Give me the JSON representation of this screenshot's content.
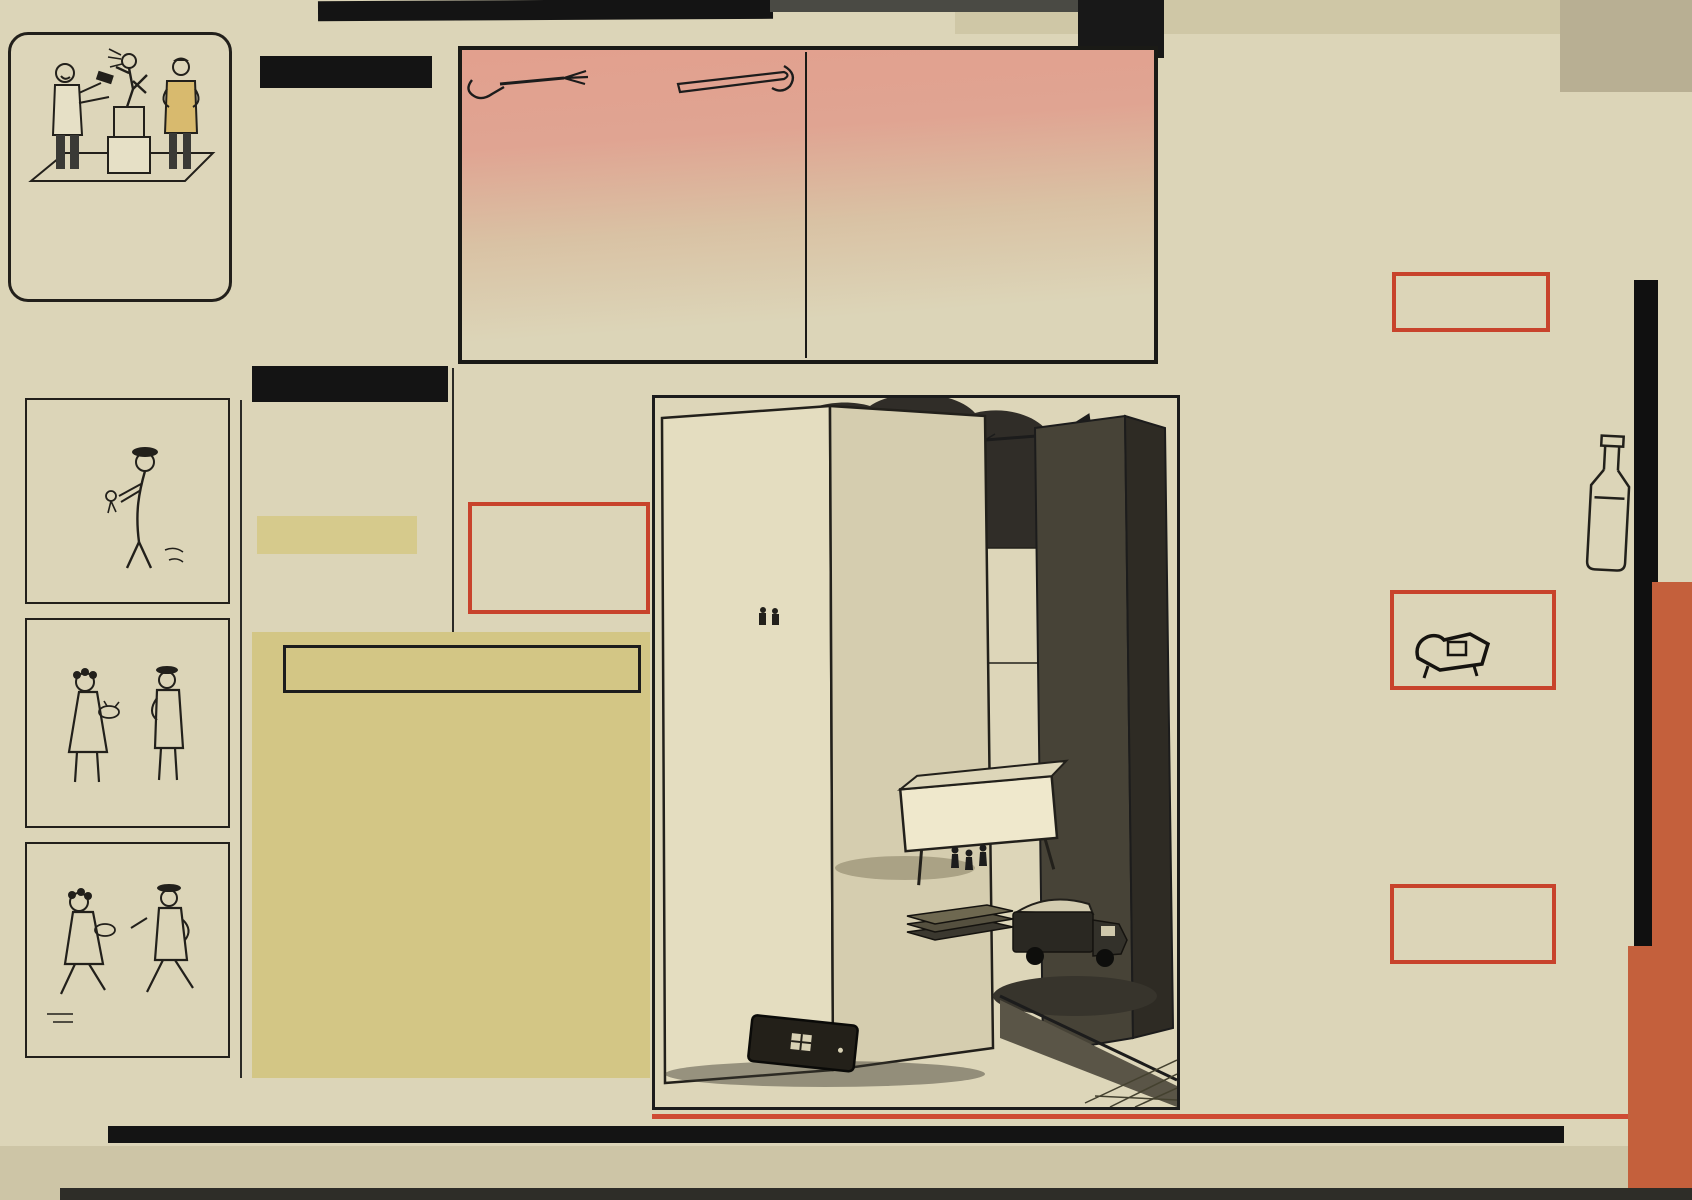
{
  "pzu": {
    "caption_l1": "–To JEST RZEŹBA CZŁOWIEKA",
    "caption_l2": "RADOSNEGO bo UBEZPIECZO-",
    "caption_l3a": "NEGO w ",
    "caption_l3b": "PZU",
    "caption_l3c": " od WYPADKÓW",
    "caption_l4": "NIESZCZĘŚLIWYCH",
    "code": "K—401"
  },
  "lengren": {
    "credit": "Rys. ZBIGNIEW LENGREN",
    "signature": "LENGREN"
  },
  "nieslychane": {
    "title": "NIESŁYCHANE!",
    "p1": "Z „Dziennika Polskiego” dowiadujemy się, że:",
    "p2": "Irena Kirszenstein znakomicie godzi studia z zajęciami naukowymi.",
    "p3": "I to ma być takie dziwne?",
    "credit": "(Nadesłała: K. Zgud-Bikart)"
  },
  "zachwaszczona": {
    "title": "Zachwaszczona działka",
    "p1": "Tytuł z nru 10/11 „Działkowca”:",
    "p2": "Dlaczego uprawiam czarną pożeczkę",
    "p3": "Słuszne pytanie, najpierw należałoby uprawiać ortografię.",
    "credit": "(Nadesłała: Agatka)"
  },
  "kielecczyzna": {
    "title": "Na Kielecczyźnie",
    "p1": "W nrze 2 „Ilustrowanego Kuriera Polskiego” podano następującą wiadomość:",
    "p2": "Wracają ptaki. Na Kielecczyźnie nastąpiło dalsze ocielenie pogody...",
    "p3": "I stąd właśnie ten byk.",
    "credit": "(Nadesłał: S. Tomaszewski)"
  },
  "dyplomata": {
    "title": "DYPLOMATA",
    "p1": "W nrze 2 „7 Głosu Tygodnia” czytamy:",
    "p2": "Mieszko I był wielkim mężem stanu, umiejącym",
    "cont1": "nie tylko iść naprzód, ale i chwilowo się cofać.",
    "cont2": "Bo znał już pewnie piosenkę: Raz na lewo, raz na prawo, trochę naprzód, trochę w tył...",
    "credit": "(Nadesłał: X)"
  },
  "wacusiu": {
    "title": "O WACUSIU",
    "box_choroba": "— Najstraszliwsza choroba naszych czasów charakteryzuje się biegunką słów przy jednoczesnej obstrukcji myśli.",
    "box_skrot": "— Skr. — skrót skrótu.",
    "box_aktorki": "— Aktorki są to śliczne dziewczyny, którym regularnie co dziesięć lat przybywa jeden rok.",
    "box_adam": "— A d a m :  najpierwszy przypadek liczby pojedynczej."
  },
  "recipe": {
    "brand1": "JEDNO",
    "brand2": "DANIE",
    "script": "Redaguje",
    "editor": "JAN KAŁKOWSKI",
    "kids_title": "DLA DZIECI",
    "kids_intro_bold": "PODAJE: p. Józefa W. z Wrocławia,",
    "kids_intro_rest": " babcia, która wypróbowała to danie na swych wnuczkach i stwierdziła, że im bardzo smakowało. Będą to POMARAŃCZE W CIEŚCIE.",
    "kids_p2": "Podajemy porcję na 2—3 osoby, przy czym na każdą bierze się jedną pomarańczę średniej wielkości. Szklankę zsiadłego mleka lub kwaśnej śmietany rozbić widelcem w garnuszku razem z jednym jajkiem. Dodawać mąkę roztrzepując nadal widelcem. Mąki powinno być tyle, aby powstało ciasto jak na lane kluski: dość gęste, ale lejące. Dosypać szczyptę soli do smaku.",
    "kids_p3": "Pomarańcze obrać ze skórki. Skroić je w poprzek na plastry (do 1 cm grubości), które z kolei należy",
    "adults_cont": "maczać w cieście i kłaść na rozgrzaną margarynę na patelnię. Tłuszczu powinno być dość dużo. Placuszki po usmażeniu z obu stron na złoto posypać cukrem pudrem i jeść na ciepło.",
    "adults_title": "DLA DOROSŁYCH",
    "adults_intro_bold": "PODAJE: p. Krystyna Smyczyńska z Świnoujścia",
    "adults_intro_rest": " w bardzo silnym i obszernym liście (dziękujemy!). Będzie to nie tyle danie, co — napój, a mianowicie KRUPNIK, w okresie zimy i karnawału zasługujący na przypomnienie.",
    "adults_p2": "Gdybyśmy go chcieli robić według przepisu z wydanej niedawno książki Jana Cieślaka „Domowy wyrób win...”, to już oczywiście na karnawał nie zdążyłoby się. No bo na samą esencję korzenną trzeba czekać 14 dni, a potem na klarowanie krupniku w gąsiorze 3 do 6 miesięcy. P. Smyczyńska proponuje nam wypróbowany, a szybszy sposób.",
    "adults_p3": "Zagotować szklankę wody ze szklanką miodu. Dodać 6 goździków, laskę cynamonu, pół laski wanilii, kawałeczek gałki muszkatołowej i trochę skórki pomarańczowej. Zagotować razem przez 5 minut i odstawić na jakiś czas (minimum pół godziny). Przecedzić i ponownie zagotować. Po zdjęciu z ognia dolać ½ l. spirytusu. Zamieszać. Pić na gorąco, małymi łyczkami z glinianych kieliszeczków lub małych filiżanek do kawy. Jest to napój do smakowania, a nie zalewania się!"
  },
  "humor": {
    "title": "Humor zeszytów",
    "star": "★",
    "items": [
      "Piękna jak słowik była Urszulka, którą ogromny smok nasycił sobie gardło.",
      "Krzyżowcy była to ludność przebywająca na Ziemi Świętej i siadająca ze skrzyżowanymi nogami.",
      "Musiał rozbierać zdanie z gramatyki.",
      "Na jednej ze ścian w naszej klasie wiszą pisarze i poeci.",
      "Autor napisał tę nowelkę jako ostrogę dla pozostałych Polaków.",
      "Akt niepodległości Królestwa Polskiego głosił że obaj cesarze ułożyli się do snu.",
      "Gdy się pali stodoła to strażacy wyją.",
      "Demostenes wygłaszał filipinki.",
      "Historia zawsze krzywdzi Polskę, bo nic nie wspomina o locie Twardowskiego.",
      "Kazimierz Wielki nie miał żony ani męża.",
      "W maju suczka chrabąszcza znosi jajka."
    ],
    "footer_main": "Nadesłali nasi Czytelnicy: mgr W. Kowalski z Łodzi, J. Leśko z Przemyśla, mgr Dorota Kotusz, E. Kulczyńska, Matylda Boroń z pow. Wadowice, AS z W., Joanna L. z Kępna, Teresa Sendecka z K.",
    "footer_thanks": "Dziękujemy."
  },
  "poem": {
    "author": "Ludwik Jerzy Kern",
    "title": "ŻYCIE NA ORBICIE",
    "stanzas": [
      "Odkąd szlaki Kosmosu\nZostały podbite,\nPolak zamiast się wlewać,\nWchodzi na orbitę.",
      "Nic dziwnego. W tym względzie\nMy już przed wiekami\nPionierami byliśmy\nI prekursorami.",
      "Inni wciąż jeszcze piją\nWino albo piwo,\nA myśmy dawno przeszli\nNa ciężkie paliwo.",
      "Na wyrzutniach jest pełno,\nPrzy rakietach tłok —\nPrzylądki Kennedy'ego\nMy mamy co krok.",
      "Sety zgrabnie odmierza\nDobra panna Lala:\n— Brzdęk, panowie! Startujem!\nPierwszy człon odpala.",
      "Na początku bywają\nPewne wątpliwości,\nAle potem ogarnia nas\nStan nieważkości.",
      "Leciutcy się robimy,\nWszystkie smutki won!\n— Brzdęk, panowie! Odpalić\nTrzeba drugi człon!",
      "Zamiast zalienowani być\nI sfrustrowani,\nDzięki bani jesteśmy\nWyorbitowani.",
      "Płyniemy w tym Kosmosie\nI nim dzień zaświta\nApogeum osiąga\nTa nasza orbita.",
      "Potem schodzimy niżej,\nBy lądować w końcu\nCałkiem jak astronauci.\nZnaczy na leżąco."
    ]
  },
  "illustration": {
    "caption": "— To się dzieje za każdym trzaśnięciem drzwi.",
    "sign_line1": "BUDOWNICTWO",
    "sign_line2": "z PREFABRYKATÓW"
  },
  "artifacts": {
    "pencil_note": "H — ✳ ‖ ←"
  }
}
